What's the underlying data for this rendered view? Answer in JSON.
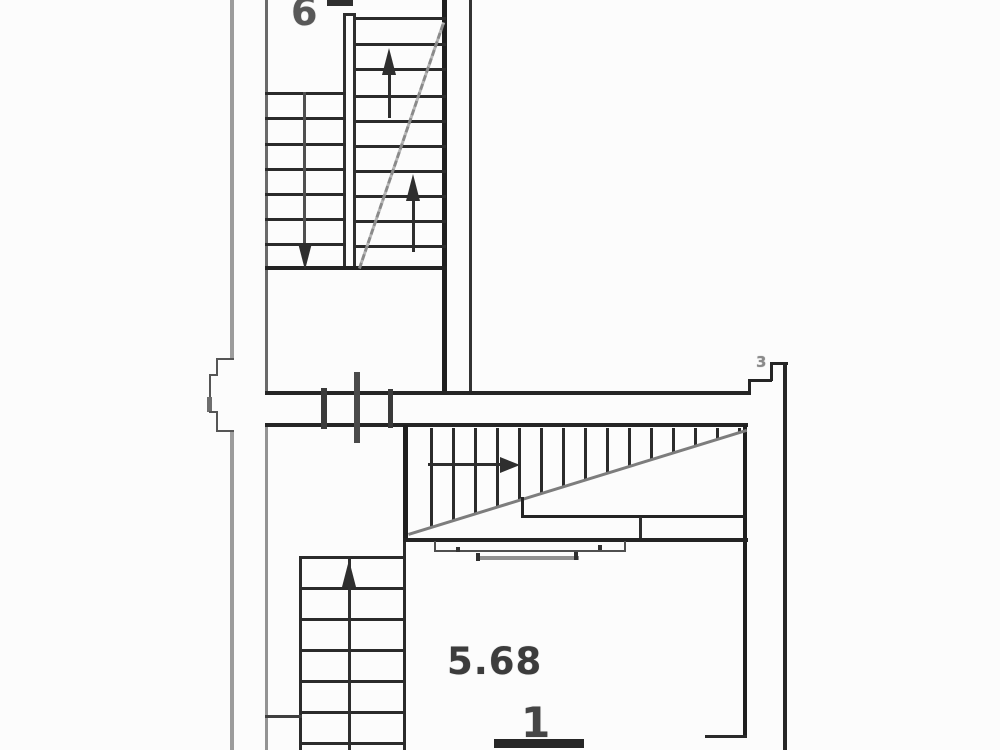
{
  "title": "Scanned architectural floor plan with two stairwells",
  "labels": {
    "floor_number": "6",
    "area_value": "5.68",
    "section_mark": "1",
    "corner_mark": "3"
  }
}
